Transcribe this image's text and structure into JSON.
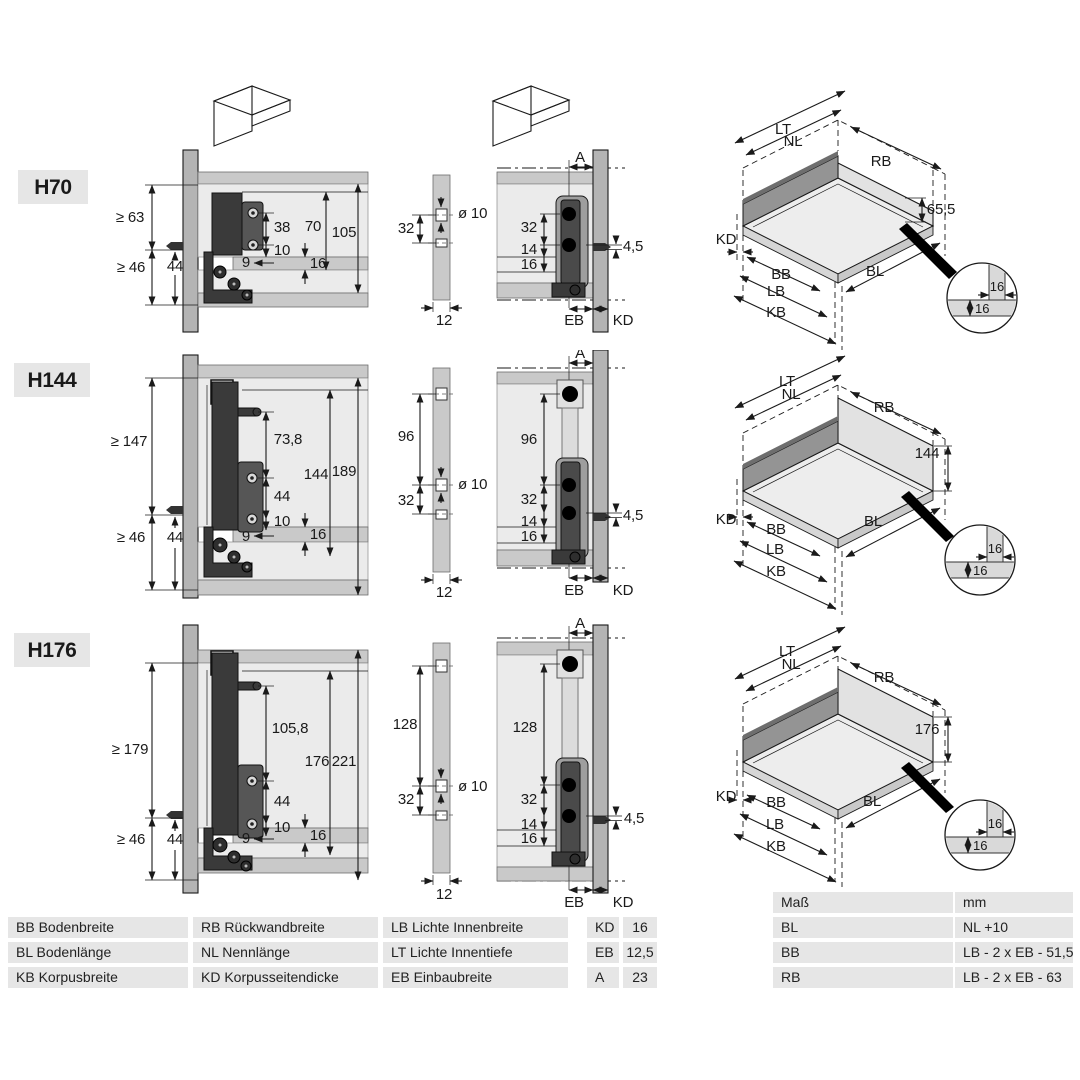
{
  "palette": {
    "panel_gray": "#b4b4b4",
    "band_gray": "#c9c9c9",
    "interior_gray": "#ebebeb",
    "dark_profile": "#3a3a3a",
    "table_cell": "#e6e6e6",
    "text": "#1a1a1a"
  },
  "pictograms": {
    "left": "drawer-open-front-icon",
    "right": "drawer-back-panel-icon"
  },
  "rows": [
    {
      "label": "H70",
      "side": {
        "min_top": "≥ 63",
        "min_bottom": "≥ 46",
        "d44": "44",
        "hole_span": "38",
        "hole_off": "10",
        "d9": "9",
        "inner_h": "70",
        "total_h": "105",
        "bottom_t": "16"
      },
      "drill": {
        "span32": "32",
        "dia": "ø 10",
        "thick": "12"
      },
      "rear": {
        "a": "A",
        "span32": "32",
        "d14": "14",
        "d16": "16",
        "d45": "4,5",
        "eb": "EB",
        "kd": "KD"
      },
      "iso": {
        "lt": "LT",
        "nl": "NL",
        "rb": "RB",
        "kd": "KD",
        "bb": "BB",
        "lb": "LB",
        "kb": "KB",
        "bl": "BL",
        "h": "65,5"
      },
      "detail": {
        "a": "16",
        "b": "16"
      }
    },
    {
      "label": "H144",
      "side": {
        "min_top": "≥ 147",
        "min_bottom": "≥ 46",
        "d44": "44",
        "top_span": "73,8",
        "hole_span": "44",
        "hole_off": "10",
        "d9": "9",
        "inner_h": "144",
        "total_h": "189",
        "bottom_t": "16"
      },
      "drill": {
        "top_span": "96",
        "span32": "32",
        "dia": "ø 10",
        "thick": "12"
      },
      "rear": {
        "a": "A",
        "top_span": "96",
        "span32": "32",
        "d14": "14",
        "d16": "16",
        "d45": "4,5",
        "eb": "EB",
        "kd": "KD"
      },
      "iso": {
        "lt": "LT",
        "nl": "NL",
        "rb": "RB",
        "kd": "KD",
        "bb": "BB",
        "lb": "LB",
        "kb": "KB",
        "bl": "BL",
        "h": "144"
      },
      "detail": {
        "a": "16",
        "b": "16"
      }
    },
    {
      "label": "H176",
      "side": {
        "min_top": "≥ 179",
        "min_bottom": "≥ 46",
        "d44": "44",
        "top_span": "105,8",
        "hole_span": "44",
        "hole_off": "10",
        "d9": "9",
        "inner_h": "176",
        "total_h": "221",
        "bottom_t": "16"
      },
      "drill": {
        "top_span": "128",
        "span32": "32",
        "dia": "ø 10",
        "thick": "12"
      },
      "rear": {
        "a": "A",
        "top_span": "128",
        "span32": "32",
        "d14": "14",
        "d16": "16",
        "d45": "4,5",
        "eb": "EB",
        "kd": "KD"
      },
      "iso": {
        "lt": "LT",
        "nl": "NL",
        "rb": "RB",
        "kd": "KD",
        "bb": "BB",
        "lb": "LB",
        "kb": "KB",
        "bl": "BL",
        "h": "176"
      },
      "detail": {
        "a": "16",
        "b": "16"
      }
    }
  ],
  "legend": {
    "rows": [
      [
        "BB Bodenbreite",
        "RB Rückwandbreite",
        "LB Lichte Innenbreite"
      ],
      [
        "BL Bodenlänge",
        "NL Nennlänge",
        "LT Lichte Innentiefe"
      ],
      [
        "KB Korpusbreite",
        "KD Korpusseitendicke",
        "EB Einbaubreite"
      ]
    ]
  },
  "kv": {
    "rows": [
      [
        "KD",
        "16"
      ],
      [
        "EB",
        "12,5"
      ],
      [
        "A",
        "23"
      ]
    ]
  },
  "mass": {
    "headers": [
      "Maß",
      "mm"
    ],
    "rows": [
      [
        "BL",
        "NL +10"
      ],
      [
        "BB",
        "LB - 2 x EB - 51,5"
      ],
      [
        "RB",
        "LB - 2 x EB - 63"
      ]
    ]
  }
}
